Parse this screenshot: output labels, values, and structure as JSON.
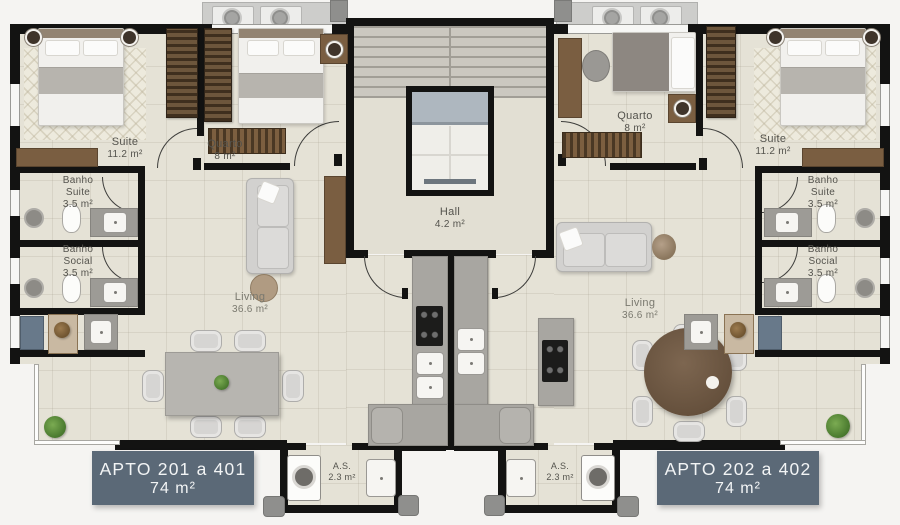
{
  "apartments": {
    "left": {
      "badge": {
        "line1": "APTO 201 a 401",
        "line2": "74 m²"
      },
      "suite": {
        "name": "Suite",
        "area": "11.2  m²"
      },
      "quarto": {
        "name": "Quarto",
        "area": "8 m²"
      },
      "banho_suite": {
        "line1": "Banho",
        "line2": "Suite",
        "area": "3.5 m²"
      },
      "banho_social": {
        "line1": "Banho",
        "line2": "Social",
        "area": "3.5 m²"
      },
      "living": {
        "name": "Living",
        "area": "36.6 m²"
      },
      "service": {
        "name": "A.S.",
        "area": "2.3 m²"
      }
    },
    "right": {
      "badge": {
        "line1": "APTO 202 a 402",
        "line2": "74 m²"
      },
      "suite": {
        "name": "Suite",
        "area": "11.2 m²"
      },
      "quarto": {
        "name": "Quarto",
        "area": "8 m²"
      },
      "banho_suite": {
        "line1": "Banho",
        "line2": "Suite",
        "area": "3.5 m²"
      },
      "banho_social": {
        "line1": "Banho",
        "line2": "Social",
        "area": "3.5 m²"
      },
      "living": {
        "name": "Living",
        "area": "36.6 m²"
      },
      "service": {
        "name": "A.S.",
        "area": "2.3 m²"
      }
    }
  },
  "common": {
    "hall": {
      "name": "Hall",
      "area": "4.2 m²"
    }
  },
  "colors": {
    "wall": "#131312",
    "floor": "#e5e2d6",
    "badge": "#5b6977",
    "plant_green": "#4c7c30",
    "shaft_blue": "#68798a"
  }
}
